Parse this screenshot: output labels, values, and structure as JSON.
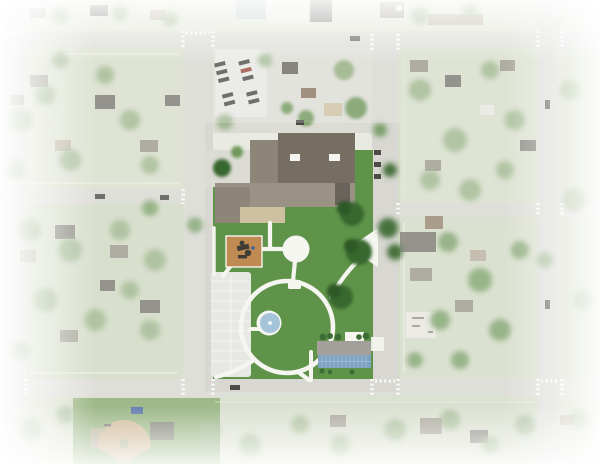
{
  "meta": {
    "description": "Aerial photograph of a small-town street grid with a proposed park site plan rendered on the central block; edges fade to white",
    "view": "top-down aerial"
  },
  "features": {
    "park": "central park site plan with loop path, circular plaza, playground, splash pad, parking lot and solar-roof building",
    "school_building": "large flat-roof building complex at top of park block",
    "baseball_field": "ball diamond in lower-left block",
    "street_grid": "two horizontal and four vertical streets with dashed crosswalks",
    "surroundings": "washed-out residential blocks with houses and tree canopy"
  },
  "colors": {
    "base": "#e9ebe2",
    "block1": "#d6ddc9",
    "block2": "#dde2d3",
    "block3": "#cfd8c1",
    "block4": "#d3dac6",
    "street": "#d8d7d1",
    "sidewalk": "#f3f3ee",
    "lawn": "#5f9349",
    "path": "#f6f6f1",
    "parking": "#e7e8e4",
    "parkingLine": "#fafaf7",
    "playground": "#c08b52",
    "equip": "#3f3b37",
    "splash": "#a5c4da",
    "splashDot": "#ecf2f6",
    "bldgDark": "#766e63",
    "bldgMid": "#8d8578",
    "bldgLow": "#9a9285",
    "courtyard": "#cec1a2",
    "bldgSmall": "#68635b",
    "solarRoof": "#a39f9a",
    "solarPanel": "#7ea2c1",
    "solarGrid": "#a9c4d8",
    "hedge": "#3c6b33",
    "treeMuted": "#8fac7d",
    "treeMid": "#6f975c",
    "treeDark": "#39682f",
    "treeDarker": "#2e5827",
    "roofGray": "#918b82",
    "roofDark": "#6b6761",
    "roofBrown": "#8a7460",
    "roofTan": "#b3a794",
    "roofWhite": "#e9e8e2",
    "tealRoof": "#b2c4c1",
    "concrete": "#dcdcd5",
    "field": "#87a86d",
    "infield": "#c7ae85",
    "car": "#4d4b47",
    "carBlue": "#42609f",
    "carRed": "#9c4a3e",
    "white": "#ffffff"
  }
}
